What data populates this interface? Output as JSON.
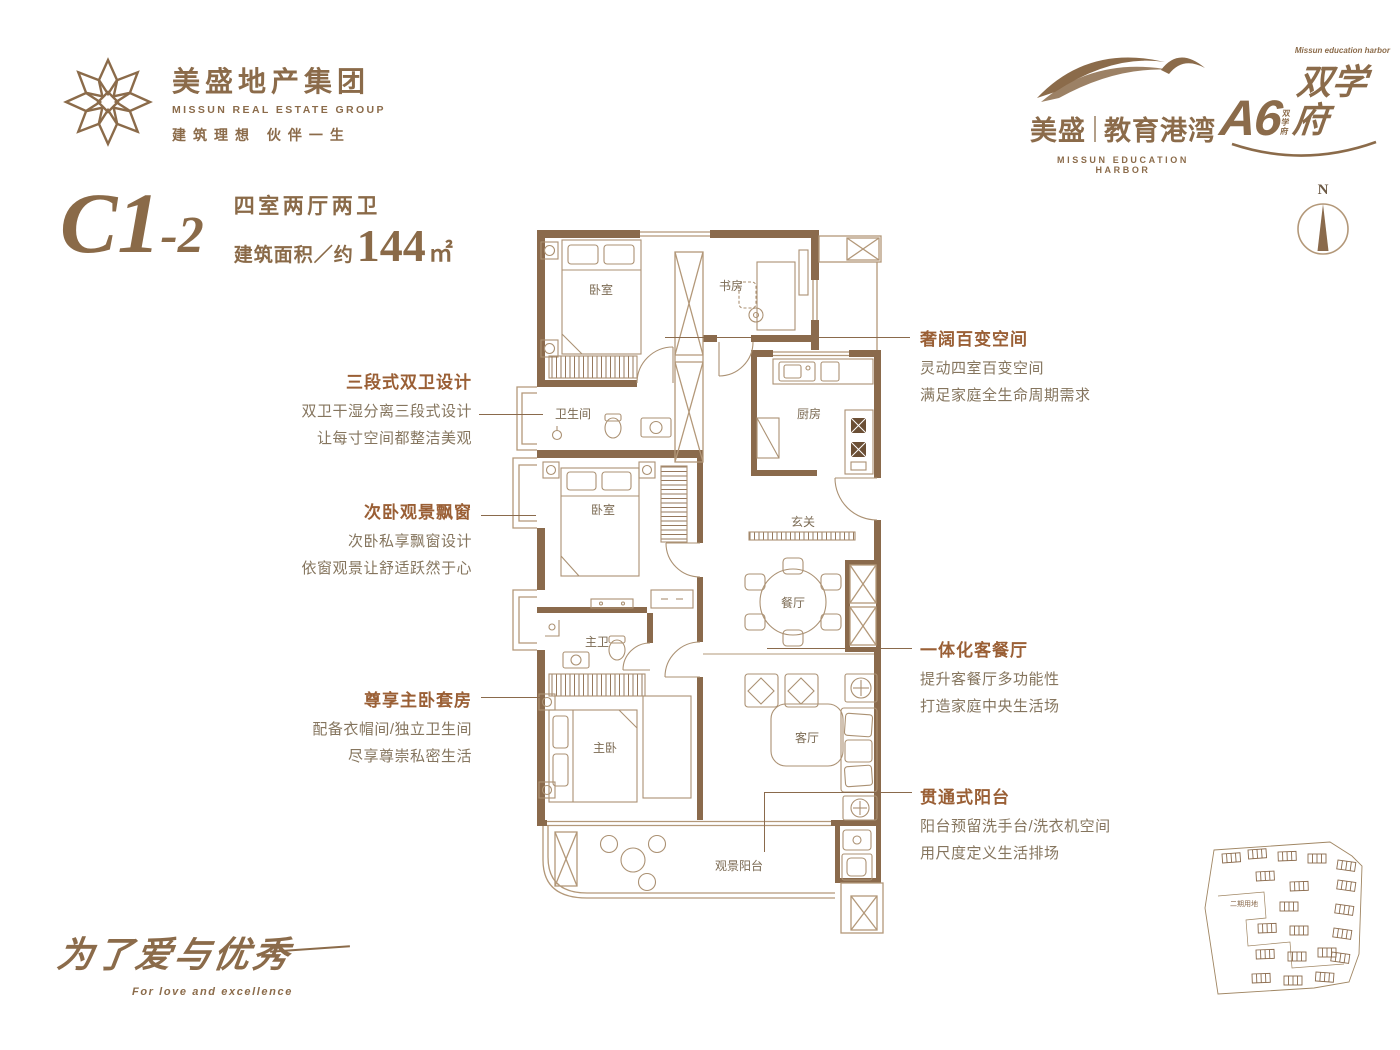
{
  "brand": {
    "group": {
      "name_cn": "美盛地产集团",
      "name_en": "MISSUN REAL ESTATE GROUP",
      "slogan": "建筑理想 伙伴一生"
    },
    "education": {
      "name_left": "美盛",
      "name_right": "教育港湾",
      "name_en": "MISSUN EDUCATION HARBOR"
    },
    "project": {
      "main": "A6",
      "vertical": "双学府",
      "suffix": "双学府",
      "tagline_en": "Missun education harbor"
    }
  },
  "unit": {
    "code_main": "C1",
    "code_sub": "-2",
    "layout": "四室两厅两卫",
    "area_prefix": "建筑面积／约",
    "area_value": "144",
    "area_unit": "㎡"
  },
  "compass": {
    "label": "N"
  },
  "rooms": {
    "bedroom_top": "卧室",
    "study": "书房",
    "bathroom": "卫生间",
    "kitchen": "厨房",
    "foyer": "玄关",
    "dining": "餐厅",
    "bedroom_mid": "卧室",
    "master_bath": "主卫",
    "master_bedroom": "主卧",
    "living": "客厅",
    "balcony": "观景阳台"
  },
  "annotations": {
    "left": [
      {
        "title": "三段式双卫设计",
        "line1": "双卫干湿分离三段式设计",
        "line2": "让每寸空间都整洁美观"
      },
      {
        "title": "次卧观景飘窗",
        "line1": "次卧私享飘窗设计",
        "line2": "依窗观景让舒适跃然于心"
      },
      {
        "title": "尊享主卧套房",
        "line1": "配备衣帽间/独立卫生间",
        "line2": "尽享尊崇私密生活"
      }
    ],
    "right": [
      {
        "title": "奢阔百变空间",
        "line1": "灵动四室百变空间",
        "line2": "满足家庭全生命周期需求"
      },
      {
        "title": "一体化客餐厅",
        "line1": "提升客餐厅多功能性",
        "line2": "打造家庭中央生活场"
      },
      {
        "title": "贯通式阳台",
        "line1": "阳台预留洗手台/洗衣机空间",
        "line2": "用尺度定义生活排场"
      }
    ]
  },
  "footer": {
    "slogan_cn": "为了爱与优秀",
    "slogan_en": "For love and excellence"
  },
  "siteplan": {
    "label": "二期用地"
  },
  "colors": {
    "brand": "#8b6b4a",
    "accent": "#9a5f35",
    "wall": "#8a6a4c",
    "line": "#b39879",
    "text": "#857257"
  }
}
